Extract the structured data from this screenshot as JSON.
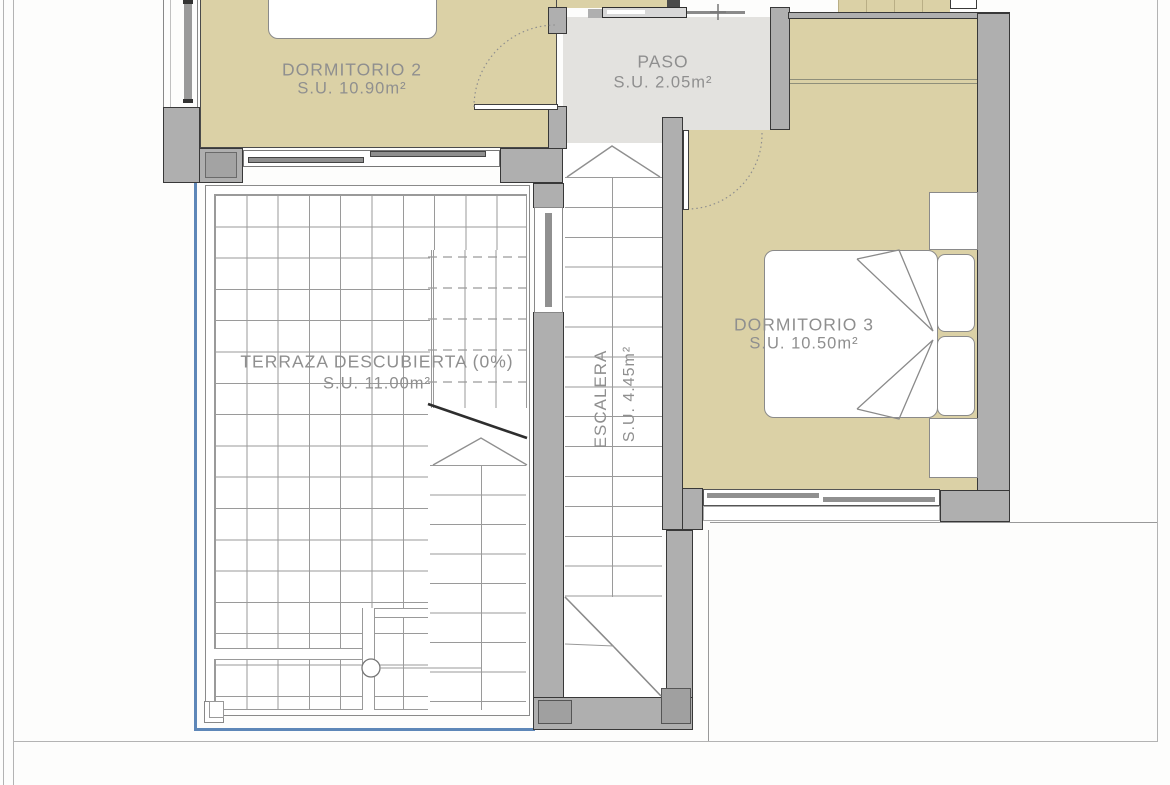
{
  "title": "Floor plan - upper level",
  "rooms": {
    "dormitorio2": {
      "label": "DORMITORIO 2",
      "area": "S.U. 10.90m²"
    },
    "paso": {
      "label": "PASO",
      "area": "S.U. 2.05m²"
    },
    "dormitorio3": {
      "label": "DORMITORIO 3",
      "area": "S.U. 10.50m²"
    },
    "terraza": {
      "label": "TERRAZA DESCUBIERTA (0%)",
      "area": "S.U. 11.00m²"
    },
    "escalera": {
      "label": "ESCALERA",
      "area": "S.U. 4.45m²"
    }
  },
  "colors": {
    "floor_beige": "#DBD1A6",
    "hall_gray": "#E3E2DF",
    "wall_gray": "#AFAFAF",
    "wall_outline": "#383838",
    "tile_line_gray": "#9A9A9A",
    "label_gray": "#8F8F8F",
    "terrace_edge_blue": "#5E87B8"
  }
}
